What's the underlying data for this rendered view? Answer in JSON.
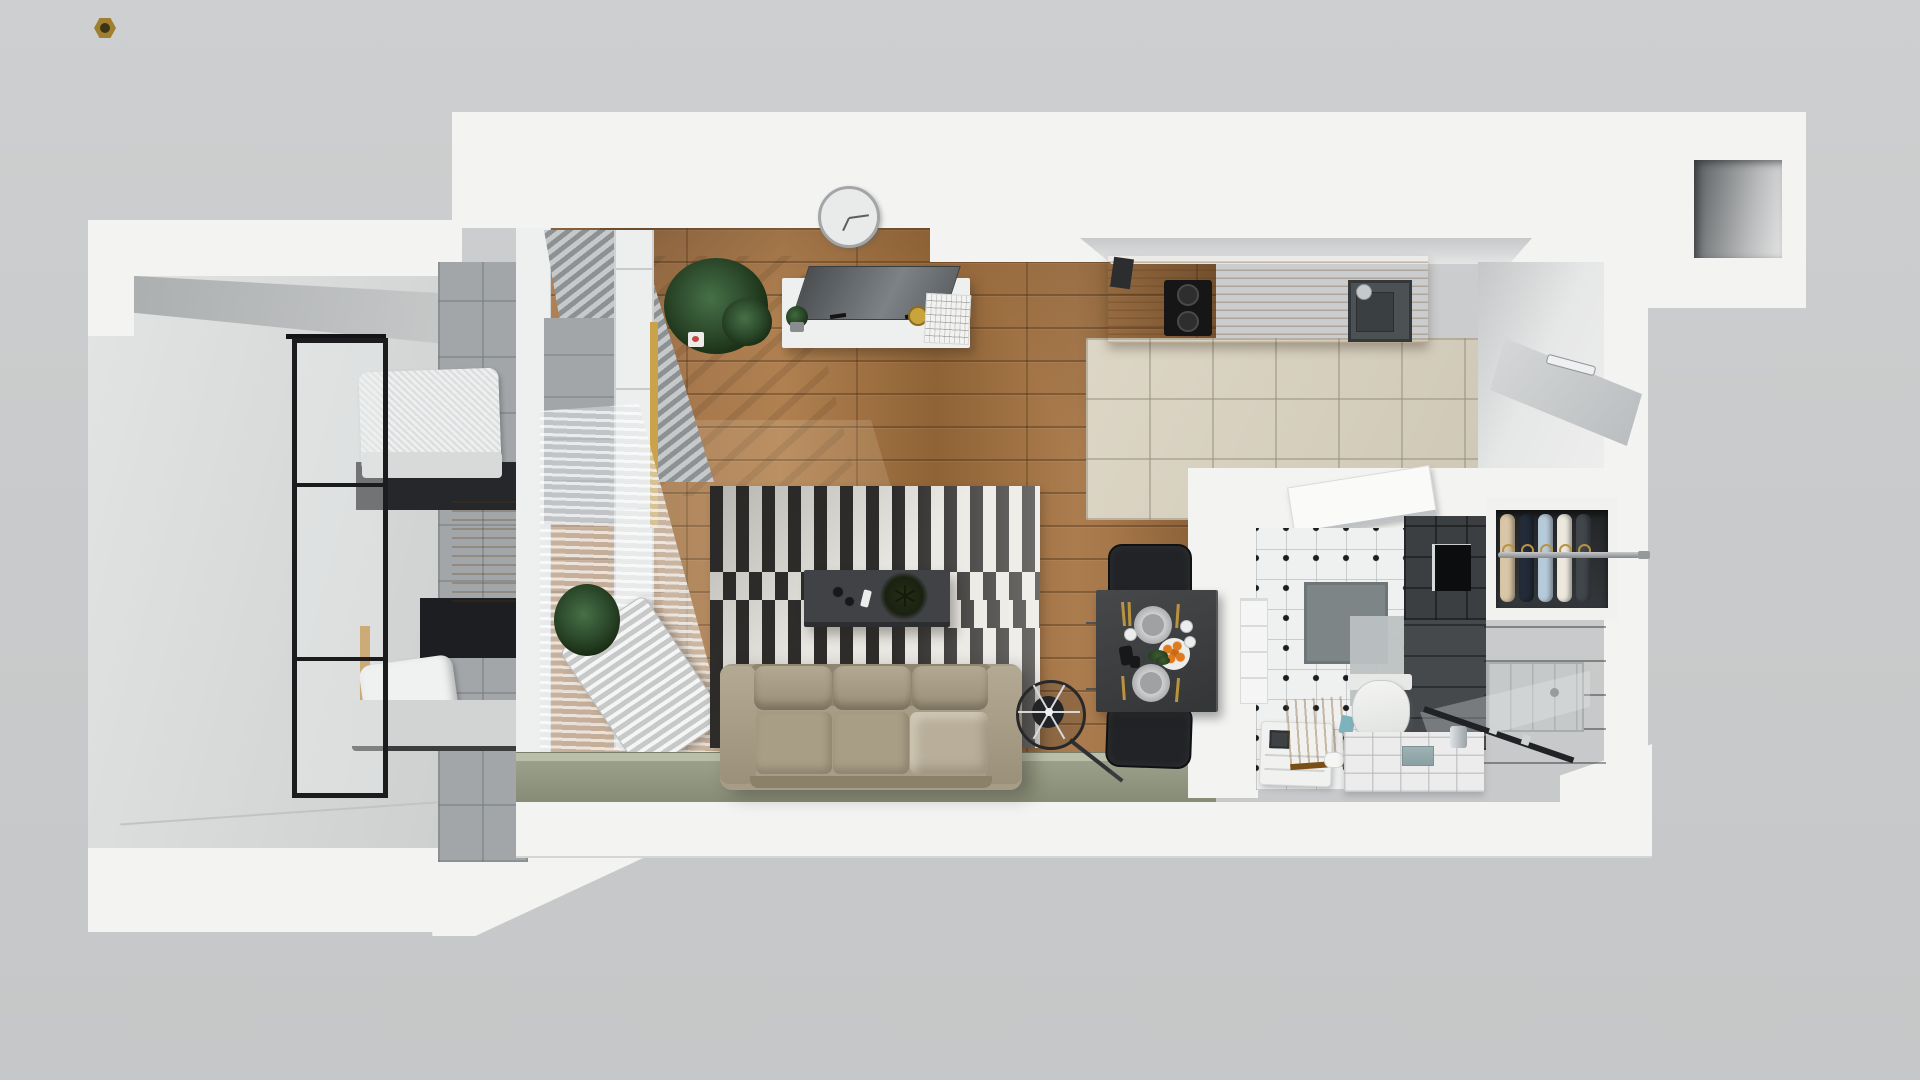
{
  "palette": {
    "bg": "#c9cbcc",
    "wall-white": "#f3f3f1",
    "wall-face": "#d7d8d8",
    "balcony-floor": "#dcdddd",
    "wood-1": "#b28354",
    "wood-2": "#8f6437",
    "counter-wood": "#b0762e",
    "kitchen-tile": "#d9d2c2",
    "olive": "#939a82",
    "rug-black": "#2e2d2b",
    "rug-white": "#e9e7e1",
    "sofa": "#a79d88",
    "charcoal": "#3b3f42",
    "concrete": "#a2a6a8",
    "bed-wood": "#c08a3c",
    "glass-frame": "#1c1c1e",
    "table-dark": "#3b3d3f",
    "chair-black": "#202224",
    "plant-green": "#2f4730",
    "gold": "#b9933f",
    "orange": "#e07a1f",
    "teal": "#7fb3bb"
  },
  "wardrobe": {
    "garments": [
      "#d8c6a6",
      "#232a38",
      "#b6cad9",
      "#ece8de",
      "#41464b"
    ]
  },
  "kitchen": {
    "burners": [
      "#2e2e2e",
      "#2e2e2e"
    ]
  },
  "counts": {
    "hangers": 5,
    "sofa_back_cushions": 3,
    "sofa_seat_cushions": 3,
    "stove_burners": 2,
    "dining_chairs": 2,
    "glass_door_mullions": 2,
    "dining_plates": 2
  }
}
